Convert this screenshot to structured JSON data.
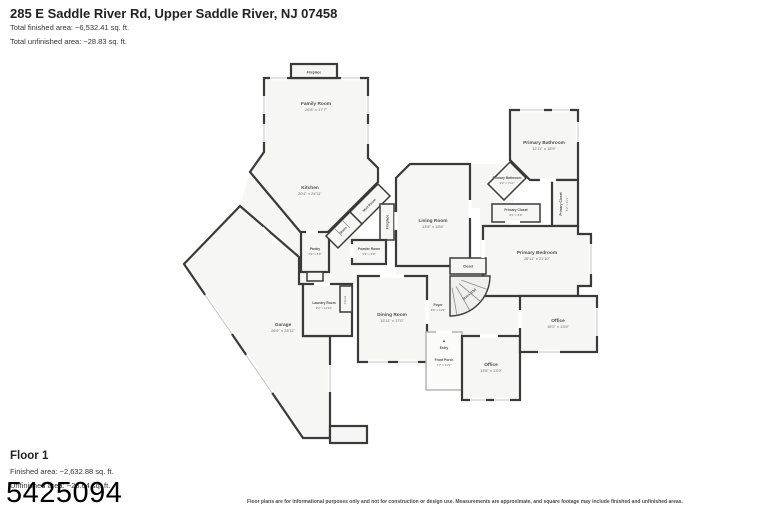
{
  "header": {
    "title": "285 E Saddle River Rd, Upper Saddle River, NJ 07458",
    "total_finished": "Total finished area: ~6,532.41 sq. ft.",
    "total_unfinished": "Total unfinished area: ~28.83 sq. ft."
  },
  "floor_summary": {
    "name": "Floor 1",
    "finished": "Finished area: ~2,632.88 sq. ft.",
    "unfinished": "Unfinished area: ~23.64 sq. ft."
  },
  "watermark": "5425094",
  "disclaimer": "Floor plans are for informational purposes only and not for construction or design use. Measurements are approximate, and square footage may include finished and unfinished areas.",
  "entry_marker": "▲",
  "colors": {
    "wall": "#3a3a3a",
    "room_fill": "#f6f6f5",
    "label": "#4e4e4e",
    "porch_wall": "#b0b0b0"
  },
  "rooms": {
    "fireplace_top": {
      "name": "Fireplace"
    },
    "family": {
      "name": "Family Room",
      "dims": "26'8\" x 17'7\""
    },
    "kitchen": {
      "name": "Kitchen",
      "dims": "20'4\" x 24'11\""
    },
    "pantry": {
      "name": "Pantry",
      "dims": "6'3\" x 8'9\""
    },
    "mud_room": {
      "name": "Mud Room"
    },
    "back_stairs": {
      "name": "Stairs"
    },
    "fireplace_living": {
      "name": "Fireplace"
    },
    "powder": {
      "name": "Powder Room",
      "dims": "5'9\" x 6'8\""
    },
    "living": {
      "name": "Living Room",
      "dims": "13'6\" x 18'6\""
    },
    "primary_bath": {
      "name": "Primary Bathroom",
      "dims": "12'11\" x 18'9\""
    },
    "primary_bath_small": {
      "name": "Primary Bathroom",
      "dims": "9'2\" x 7'10\""
    },
    "primary_closet_a": {
      "name": "Primary Closet",
      "dims": "8'2\" x 6'9\""
    },
    "primary_closet_b": {
      "name": "Primary Closet",
      "dims": "5'2\" x 11'1\""
    },
    "primary_bedroom": {
      "name": "Primary Bedroom",
      "dims": "26'11\" x 21'10\""
    },
    "closet_hall": {
      "name": "Closet"
    },
    "stairs_main": {
      "name": "Stairs (Up)"
    },
    "foyer": {
      "name": "Foyer",
      "dims": "8'6\" x 11'5\""
    },
    "dining": {
      "name": "Dining Room",
      "dims": "15'11\" x 17'0\""
    },
    "laundry": {
      "name": "Laundry Room",
      "dims": "9'2\" x 12'10\""
    },
    "closet_laundry": {
      "name": "Closet"
    },
    "garage": {
      "name": "Garage",
      "dims": "26'6\" x 28'11\""
    },
    "entry": {
      "name": "Entry"
    },
    "front_porch": {
      "name": "Front Porch",
      "dims": "7'7\" x 11'9\""
    },
    "office_center": {
      "name": "Office",
      "dims": "13'6\" x 13'9\""
    },
    "office_right": {
      "name": "Office",
      "dims": "16'2\" x 13'5\""
    }
  }
}
